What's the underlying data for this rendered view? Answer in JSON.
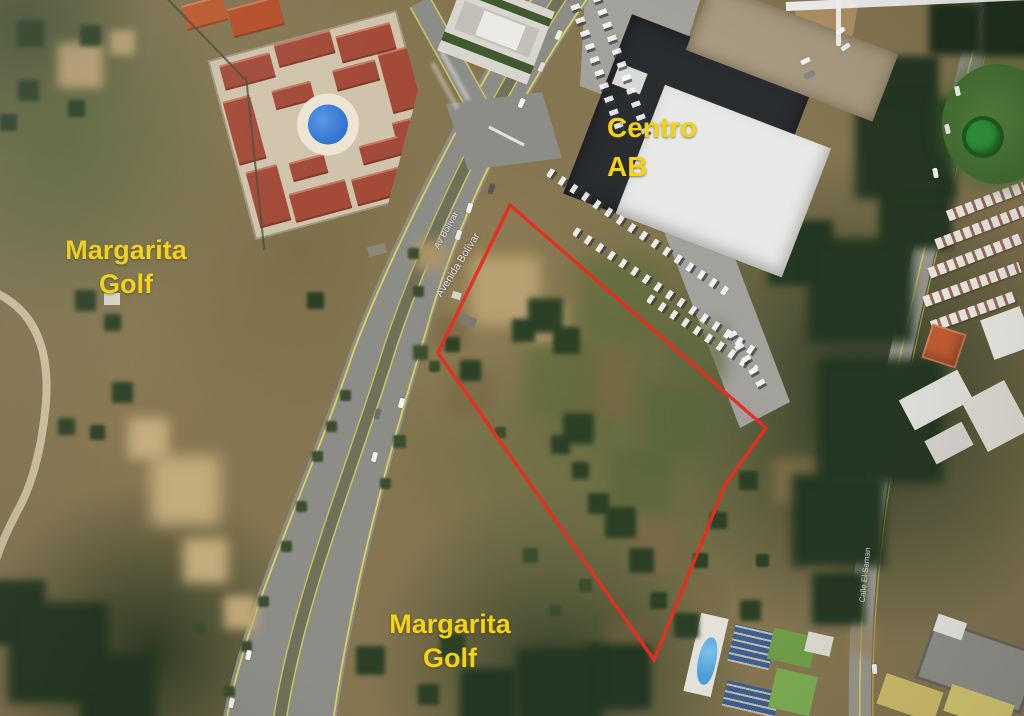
{
  "map_labels": {
    "area_left": {
      "line1": "Margarita",
      "line2": "Golf"
    },
    "area_bottom": {
      "line1": "Margarita",
      "line2": "Golf"
    },
    "centro_ab": {
      "line1": "Centro",
      "line2": "AB"
    },
    "road_short": "Av Bolívar",
    "road_long": "Avenida Bolívar",
    "road_side": "Calle El Saman"
  },
  "parcel": {
    "outline_points": "510,205 766,428 725,485 654,660 438,353"
  },
  "colors": {
    "label-yellow": "#f2d413",
    "parcel-red": "#e62e20",
    "road-asphalt": "#8d8d88",
    "road-line-yellow": "#dcd65c",
    "pool-blue": "#2f74d0",
    "roof-red": "#a34a38",
    "centro-roof-dark": "#2a2d30",
    "centro-roof-white": "#e8e8e7",
    "centro-roof-tan": "#a89a80"
  }
}
